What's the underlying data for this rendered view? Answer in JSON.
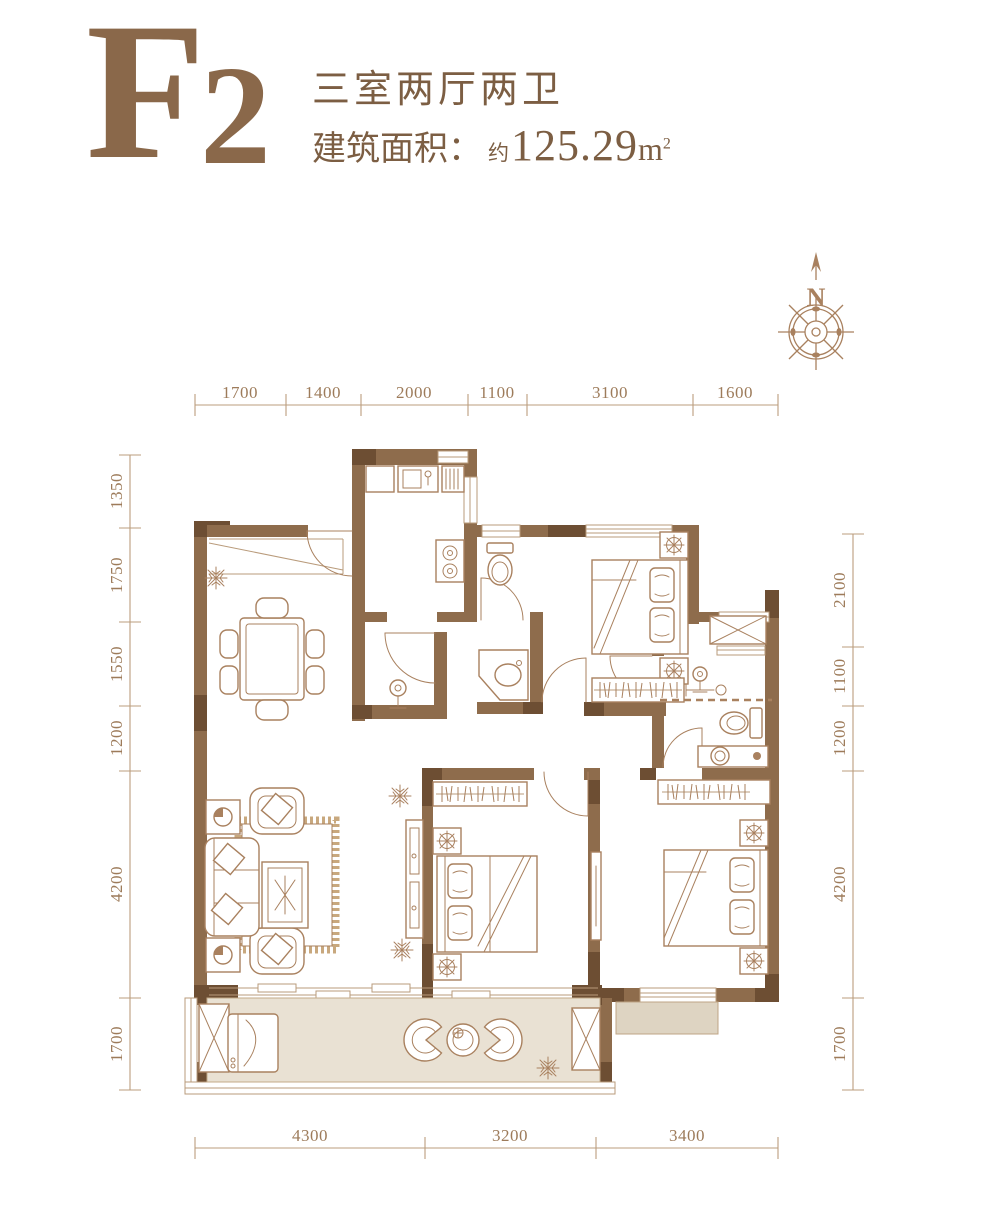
{
  "header": {
    "unit_letter": "F",
    "unit_digit": "2",
    "layout_label": "三室两厅两卫",
    "area_label": "建筑面积：",
    "area_approx": "约",
    "area_value": "125.29",
    "area_unit_base": "m",
    "area_unit_exp": "2"
  },
  "compass": {
    "north_label": "N"
  },
  "dims": {
    "top": [
      "1700",
      "1400",
      "2000",
      "1100",
      "3100",
      "1600"
    ],
    "bottom": [
      "4300",
      "3200",
      "3400"
    ],
    "left": [
      "1350",
      "1750",
      "1550",
      "1200",
      "4200",
      "1700"
    ],
    "right": [
      "2100",
      "1100",
      "1200",
      "4200",
      "1700"
    ]
  },
  "plan": {
    "furniture_icons": [
      "dining-table",
      "dining-chair",
      "sofa",
      "armchair",
      "side-table-lamp",
      "coffee-table",
      "rug",
      "tv-cabinet",
      "double-bed",
      "pillow",
      "nightstand-lamp",
      "wardrobe",
      "kitchen-sink",
      "drain-rack",
      "gas-stove",
      "toilet",
      "wash-basin",
      "corner-basin",
      "shower",
      "washing-machine",
      "lounge-chair",
      "round-table",
      "ac-platform-x",
      "duct-shaft-x",
      "snowflake-decor"
    ],
    "colors": {
      "wall": "#8e6c4c",
      "wall_dark": "#6d4e33",
      "line": "#a9815f",
      "dimension": "#9d7b5a",
      "title": "#8a684a",
      "balcony_floor": "#e9e1d3",
      "platform": "#ded4c2"
    }
  }
}
